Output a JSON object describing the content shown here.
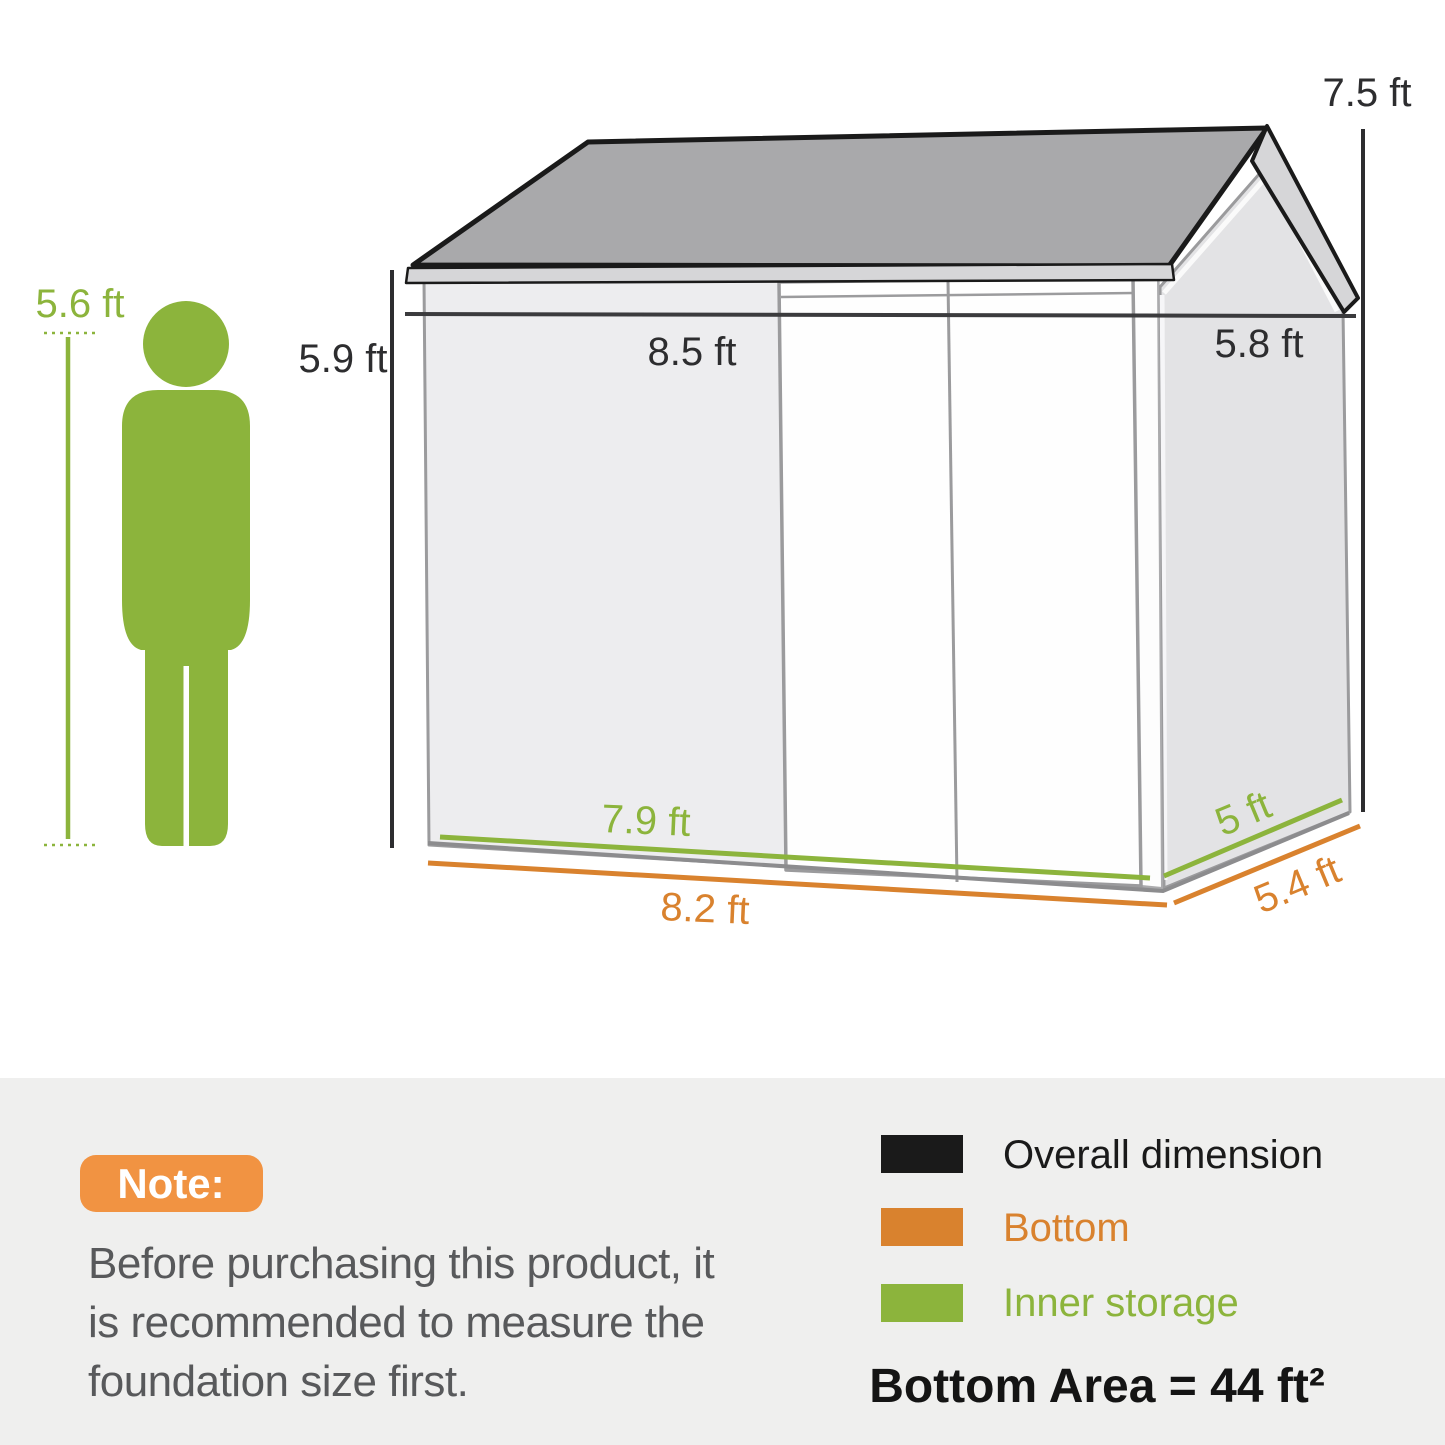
{
  "colors": {
    "green": "#8cb43c",
    "orange": "#d9822e",
    "badge_orange": "#f19342",
    "dark": "#2d2d2f",
    "black": "#1a1a1a",
    "note_text": "#58595b"
  },
  "person": {
    "height_label": "5.6 ft"
  },
  "shed": {
    "wall_height": "5.9 ft",
    "overall_height": "7.5 ft",
    "overall_width": "8.5 ft",
    "overall_depth": "5.8 ft",
    "inner_width": "7.9 ft",
    "inner_depth": "5 ft",
    "bottom_width": "8.2 ft",
    "bottom_depth": "5.4 ft"
  },
  "note": {
    "badge": "Note:",
    "line1": "Before purchasing this product, it",
    "line2": "is recommended to measure the",
    "line3": "foundation size first."
  },
  "legend": {
    "items": [
      {
        "label": "Overall dimension",
        "color": "#1a1a1a"
      },
      {
        "label": "Bottom",
        "color": "#d9822e"
      },
      {
        "label": "Inner storage",
        "color": "#8cb43c"
      }
    ],
    "bottom_area": "Bottom Area = 44 ft²"
  }
}
